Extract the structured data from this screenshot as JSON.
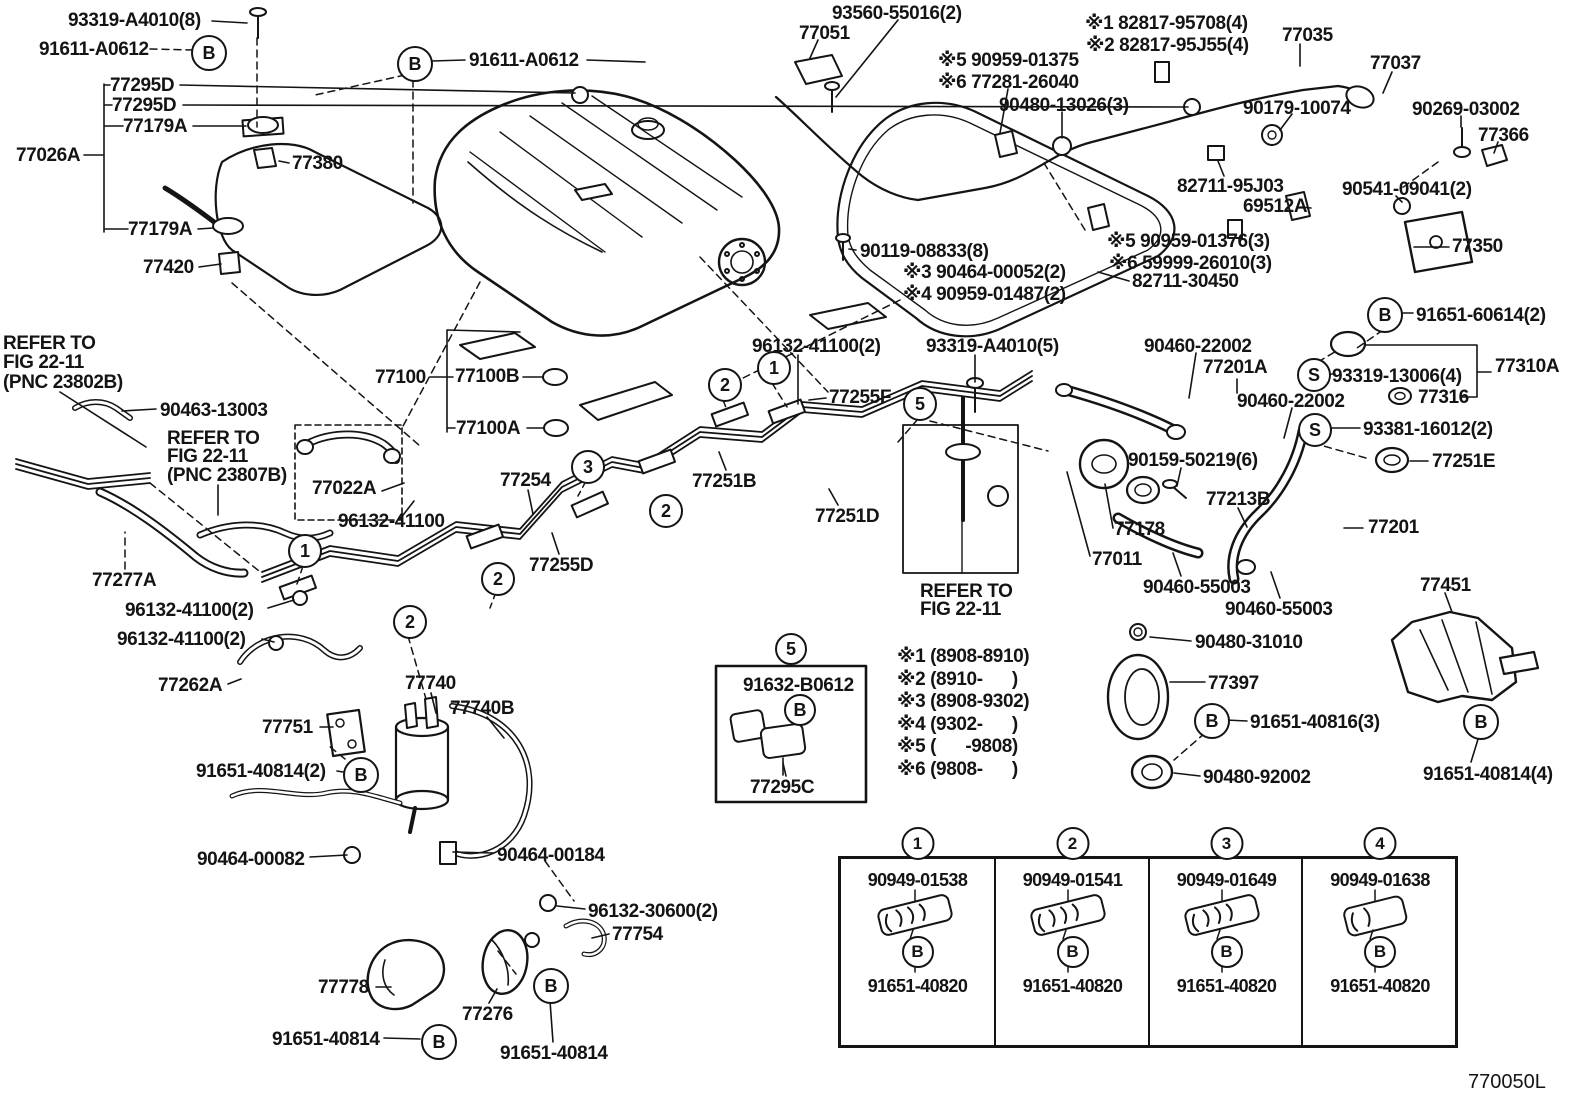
{
  "doc": {
    "number": "770050L",
    "title_semantic": "fuel-tank-and-tube-parts-diagram"
  },
  "colors": {
    "ink": "#141414",
    "paper": "#ffffff"
  },
  "labels": [
    {
      "id": "part-93319-a4010-8",
      "t": "93319-A4010(8)",
      "x": 68,
      "y": 11
    },
    {
      "id": "part-91611-a0612-left",
      "t": "91611-A0612",
      "x": 39,
      "y": 40
    },
    {
      "id": "part-77295d-1",
      "t": "77295D",
      "x": 110,
      "y": 76
    },
    {
      "id": "part-77295d-2",
      "t": "77295D",
      "x": 112,
      "y": 96
    },
    {
      "id": "part-77179a-1",
      "t": "77179A",
      "x": 123,
      "y": 117
    },
    {
      "id": "part-77026a",
      "t": "77026A",
      "x": 16,
      "y": 146
    },
    {
      "id": "part-77380",
      "t": "77380",
      "x": 292,
      "y": 154
    },
    {
      "id": "part-77179a-2",
      "t": "77179A",
      "x": 128,
      "y": 220
    },
    {
      "id": "part-77420",
      "t": "77420",
      "x": 143,
      "y": 258
    },
    {
      "id": "part-91611-a0612-right",
      "t": "91611-A0612",
      "x": 469,
      "y": 51
    },
    {
      "id": "part-93560-55016",
      "t": "93560-55016(2)",
      "x": 832,
      "y": 4
    },
    {
      "id": "part-77051",
      "t": "77051",
      "x": 799,
      "y": 24
    },
    {
      "id": "note5-90959-01375",
      "t": "※5 90959-01375",
      "x": 938,
      "y": 51
    },
    {
      "id": "note6-77281-26040",
      "t": "※6 77281-26040",
      "x": 938,
      "y": 73
    },
    {
      "id": "note1-82817-95708",
      "t": "※1 82817-95708(4)",
      "x": 1085,
      "y": 14
    },
    {
      "id": "note2-82817-95j55",
      "t": "※2 82817-95J55(4)",
      "x": 1086,
      "y": 36
    },
    {
      "id": "part-77035",
      "t": "77035",
      "x": 1282,
      "y": 26
    },
    {
      "id": "part-77037",
      "t": "77037",
      "x": 1370,
      "y": 54
    },
    {
      "id": "part-90480-13026",
      "t": "90480-13026(3)",
      "x": 999,
      "y": 96
    },
    {
      "id": "part-90179-10074",
      "t": "90179-10074",
      "x": 1243,
      "y": 99
    },
    {
      "id": "part-90269-03002",
      "t": "90269-03002",
      "x": 1412,
      "y": 100
    },
    {
      "id": "part-77366",
      "t": "77366",
      "x": 1478,
      "y": 126
    },
    {
      "id": "part-82711-95j03",
      "t": "82711-95J03",
      "x": 1177,
      "y": 177
    },
    {
      "id": "part-90541-09041",
      "t": "90541-09041(2)",
      "x": 1342,
      "y": 180
    },
    {
      "id": "part-69512a",
      "t": "69512A",
      "x": 1243,
      "y": 197
    },
    {
      "id": "part-77350",
      "t": "77350",
      "x": 1452,
      "y": 237
    },
    {
      "id": "note5-90959-01376",
      "t": "※5 90959-01376(3)",
      "x": 1107,
      "y": 232
    },
    {
      "id": "note6-59999-26010",
      "t": "※6 59999-26010(3)",
      "x": 1109,
      "y": 254
    },
    {
      "id": "part-82711-30450",
      "t": "82711-30450",
      "x": 1132,
      "y": 272
    },
    {
      "id": "part-91651-60614",
      "t": "91651-60614(2)",
      "x": 1416,
      "y": 306
    },
    {
      "id": "part-90119-08833",
      "t": "90119-08833(8)",
      "x": 860,
      "y": 242
    },
    {
      "id": "note3-90464-00052",
      "t": "※3 90464-00052(2)",
      "x": 903,
      "y": 263
    },
    {
      "id": "note4-90959-01487",
      "t": "※4 90959-01487(2)",
      "x": 903,
      "y": 285
    },
    {
      "id": "part-96132-41100-top",
      "t": "96132-41100(2)",
      "x": 752,
      "y": 337
    },
    {
      "id": "part-93319-a4010-5",
      "t": "93319-A4010(5)",
      "x": 926,
      "y": 337
    },
    {
      "id": "part-77255f",
      "t": "77255F",
      "x": 829,
      "y": 388
    },
    {
      "id": "part-90460-22002-1",
      "t": "90460-22002",
      "x": 1144,
      "y": 337
    },
    {
      "id": "part-77201a",
      "t": "77201A",
      "x": 1203,
      "y": 358
    },
    {
      "id": "part-90460-22002-2",
      "t": "90460-22002",
      "x": 1237,
      "y": 392
    },
    {
      "id": "part-93319-13006",
      "t": "93319-13006(4)",
      "x": 1332,
      "y": 367
    },
    {
      "id": "part-77310a",
      "t": "77310A",
      "x": 1495,
      "y": 357
    },
    {
      "id": "part-77316",
      "t": "77316",
      "x": 1418,
      "y": 388
    },
    {
      "id": "part-93381-16012",
      "t": "93381-16012(2)",
      "x": 1363,
      "y": 420
    },
    {
      "id": "part-77251e",
      "t": "77251E",
      "x": 1432,
      "y": 452
    },
    {
      "id": "part-90159-50219",
      "t": "90159-50219(6)",
      "x": 1128,
      "y": 451
    },
    {
      "id": "part-77213b",
      "t": "77213B",
      "x": 1206,
      "y": 490
    },
    {
      "id": "part-77178",
      "t": "77178",
      "x": 1114,
      "y": 520
    },
    {
      "id": "part-77011",
      "t": "77011",
      "x": 1092,
      "y": 550
    },
    {
      "id": "part-77201",
      "t": "77201",
      "x": 1368,
      "y": 518
    },
    {
      "id": "part-90460-55003-1",
      "t": "90460-55003",
      "x": 1143,
      "y": 578
    },
    {
      "id": "refer3-line1",
      "t": "REFER TO",
      "x": 920,
      "y": 582
    },
    {
      "id": "refer3-line2",
      "t": "FIG 22-11",
      "x": 920,
      "y": 600
    },
    {
      "id": "part-90460-55003-2",
      "t": "90460-55003",
      "x": 1225,
      "y": 600
    },
    {
      "id": "part-77451",
      "t": "77451",
      "x": 1420,
      "y": 576
    },
    {
      "id": "part-90480-31010",
      "t": "90480-31010",
      "x": 1195,
      "y": 633
    },
    {
      "id": "part-77397",
      "t": "77397",
      "x": 1208,
      "y": 674
    },
    {
      "id": "part-91651-40816",
      "t": "91651-40816(3)",
      "x": 1250,
      "y": 713
    },
    {
      "id": "part-90480-92002",
      "t": "90480-92002",
      "x": 1203,
      "y": 768
    },
    {
      "id": "part-91651-40814-4",
      "t": "91651-40814(4)",
      "x": 1423,
      "y": 765
    },
    {
      "id": "refer1-line1",
      "t": "REFER TO",
      "x": 3,
      "y": 334
    },
    {
      "id": "refer1-line2",
      "t": "FIG 22-11",
      "x": 3,
      "y": 353
    },
    {
      "id": "refer1-line3",
      "t": "(PNC 23802B)",
      "x": 3,
      "y": 373
    },
    {
      "id": "part-90463-13003",
      "t": "90463-13003",
      "x": 160,
      "y": 401
    },
    {
      "id": "refer2-line1",
      "t": "REFER TO",
      "x": 167,
      "y": 429
    },
    {
      "id": "refer2-line2",
      "t": "FIG 22-11",
      "x": 167,
      "y": 447
    },
    {
      "id": "refer2-line3",
      "t": "(PNC 23807B)",
      "x": 167,
      "y": 466
    },
    {
      "id": "part-77022a",
      "t": "77022A",
      "x": 312,
      "y": 479
    },
    {
      "id": "part-96132-41100-mid",
      "t": "96132-41100",
      "x": 338,
      "y": 512
    },
    {
      "id": "part-77277a",
      "t": "77277A",
      "x": 92,
      "y": 571
    },
    {
      "id": "part-96132-41100-b1",
      "t": "96132-41100(2)",
      "x": 125,
      "y": 601
    },
    {
      "id": "part-96132-41100-b2",
      "t": "96132-41100(2)",
      "x": 117,
      "y": 630
    },
    {
      "id": "part-77262a",
      "t": "77262A",
      "x": 158,
      "y": 676
    },
    {
      "id": "part-77740",
      "t": "77740",
      "x": 405,
      "y": 674
    },
    {
      "id": "part-77740b",
      "t": "77740B",
      "x": 450,
      "y": 699
    },
    {
      "id": "part-77751",
      "t": "77751",
      "x": 262,
      "y": 718
    },
    {
      "id": "part-91651-40814-2",
      "t": "91651-40814(2)",
      "x": 196,
      "y": 762
    },
    {
      "id": "part-90464-00082",
      "t": "90464-00082",
      "x": 197,
      "y": 850
    },
    {
      "id": "part-90464-00184",
      "t": "90464-00184",
      "x": 497,
      "y": 846
    },
    {
      "id": "part-96132-30600",
      "t": "96132-30600(2)",
      "x": 588,
      "y": 902
    },
    {
      "id": "part-77754",
      "t": "77754",
      "x": 612,
      "y": 925
    },
    {
      "id": "part-77778",
      "t": "77778",
      "x": 318,
      "y": 978
    },
    {
      "id": "part-77276",
      "t": "77276",
      "x": 462,
      "y": 1005
    },
    {
      "id": "part-91651-40814-left",
      "t": "91651-40814",
      "x": 272,
      "y": 1030
    },
    {
      "id": "part-91651-40814-right",
      "t": "91651-40814",
      "x": 500,
      "y": 1044
    },
    {
      "id": "part-77100",
      "t": "77100",
      "x": 375,
      "y": 368
    },
    {
      "id": "part-77100b",
      "t": "77100B",
      "x": 455,
      "y": 367
    },
    {
      "id": "part-77100a",
      "t": "77100A",
      "x": 456,
      "y": 419
    },
    {
      "id": "part-77254",
      "t": "77254",
      "x": 500,
      "y": 471
    },
    {
      "id": "part-77251b",
      "t": "77251B",
      "x": 692,
      "y": 472
    },
    {
      "id": "part-77255d",
      "t": "77255D",
      "x": 529,
      "y": 556
    },
    {
      "id": "part-77251d",
      "t": "77251D",
      "x": 815,
      "y": 507
    },
    {
      "id": "part-91632-b0612",
      "t": "91632-B0612",
      "x": 743,
      "y": 676
    },
    {
      "id": "part-77295c",
      "t": "77295C",
      "x": 750,
      "y": 778
    },
    {
      "id": "spec-note-1",
      "t": "※1 (8908-8910)",
      "x": 897,
      "y": 647
    },
    {
      "id": "spec-note-2",
      "t": "※2 (8910-      )",
      "x": 897,
      "y": 670
    },
    {
      "id": "spec-note-3",
      "t": "※3 (8908-9302)",
      "x": 897,
      "y": 692
    },
    {
      "id": "spec-note-4",
      "t": "※4 (9302-      )",
      "x": 897,
      "y": 715
    },
    {
      "id": "spec-note-5",
      "t": "※5 (      -9808)",
      "x": 897,
      "y": 737
    },
    {
      "id": "spec-note-6",
      "t": "※6 (9808-      )",
      "x": 897,
      "y": 760
    },
    {
      "id": "drawing-number",
      "t": "770050L",
      "x": 1468,
      "y": 1072,
      "fs": 20,
      "cls": "doc"
    }
  ],
  "markers": [
    {
      "sym": "B",
      "x": 207,
      "y": 51
    },
    {
      "sym": "B",
      "x": 413,
      "y": 62
    },
    {
      "sym": "B",
      "x": 1383,
      "y": 313
    },
    {
      "sym": "B",
      "x": 359,
      "y": 773
    },
    {
      "sym": "B",
      "x": 798,
      "y": 708,
      "r": 14
    },
    {
      "sym": "B",
      "x": 549,
      "y": 984
    },
    {
      "sym": "B",
      "x": 437,
      "y": 1040
    },
    {
      "sym": "B",
      "x": 1210,
      "y": 719
    },
    {
      "sym": "B",
      "x": 1479,
      "y": 720
    },
    {
      "sym": "S",
      "x": 1312,
      "y": 373,
      "r": 15
    },
    {
      "sym": "S",
      "x": 1313,
      "y": 428,
      "r": 15
    },
    {
      "sym": "1",
      "x": 303,
      "y": 549,
      "r": 15
    },
    {
      "sym": "1",
      "x": 772,
      "y": 366,
      "r": 15
    },
    {
      "sym": "2",
      "x": 408,
      "y": 620,
      "r": 15
    },
    {
      "sym": "2",
      "x": 496,
      "y": 577,
      "r": 15
    },
    {
      "sym": "2",
      "x": 664,
      "y": 509,
      "r": 15
    },
    {
      "sym": "2",
      "x": 723,
      "y": 383,
      "r": 15
    },
    {
      "sym": "3",
      "x": 586,
      "y": 465,
      "r": 15
    },
    {
      "sym": "5",
      "x": 918,
      "y": 402,
      "r": 15
    },
    {
      "sym": "5",
      "x": 789,
      "y": 647,
      "r": 14
    }
  ],
  "table": {
    "cols": [
      {
        "num": "1",
        "part_top": "90949-01538",
        "letter": "B",
        "part_bottom": "91651-40820"
      },
      {
        "num": "2",
        "part_top": "90949-01541",
        "letter": "B",
        "part_bottom": "91651-40820"
      },
      {
        "num": "3",
        "part_top": "90949-01649",
        "letter": "B",
        "part_bottom": "91651-40820"
      },
      {
        "num": "4",
        "part_top": "90949-01638",
        "letter": "B",
        "part_bottom": "91651-40820"
      }
    ]
  }
}
